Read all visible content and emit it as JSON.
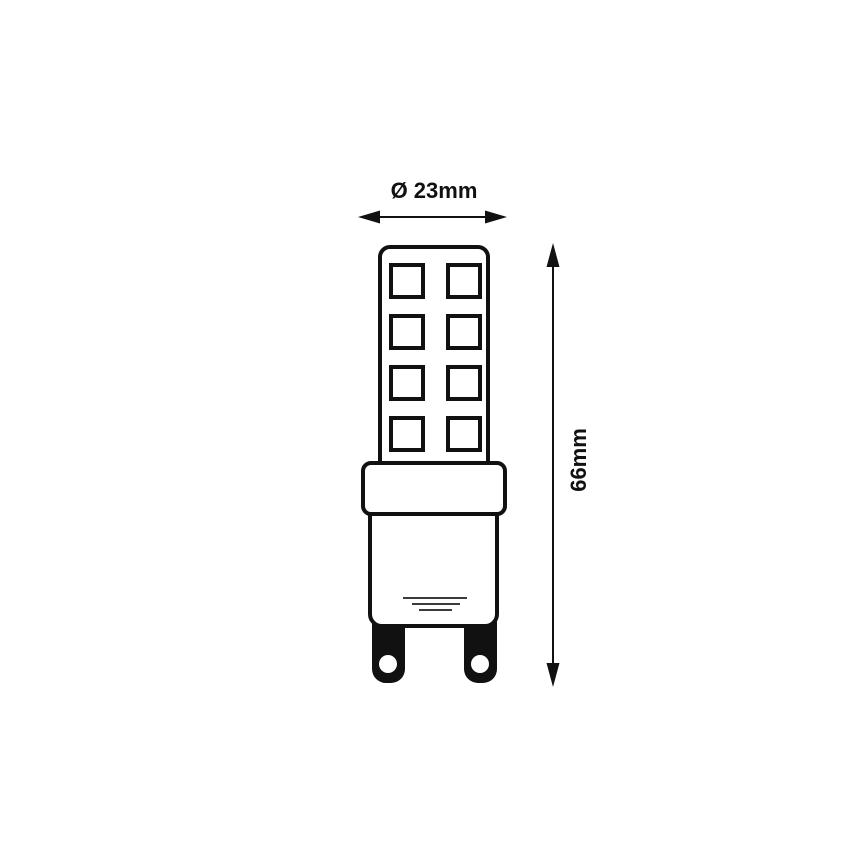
{
  "diagram": {
    "labels": {
      "diameter": "Ø 23mm",
      "height": "66mm"
    },
    "led_grid": {
      "rows": 4,
      "columns": 2
    },
    "colors": {
      "line": "#111111",
      "background": "#ffffff",
      "vent_line": "#3b3b3b"
    }
  }
}
